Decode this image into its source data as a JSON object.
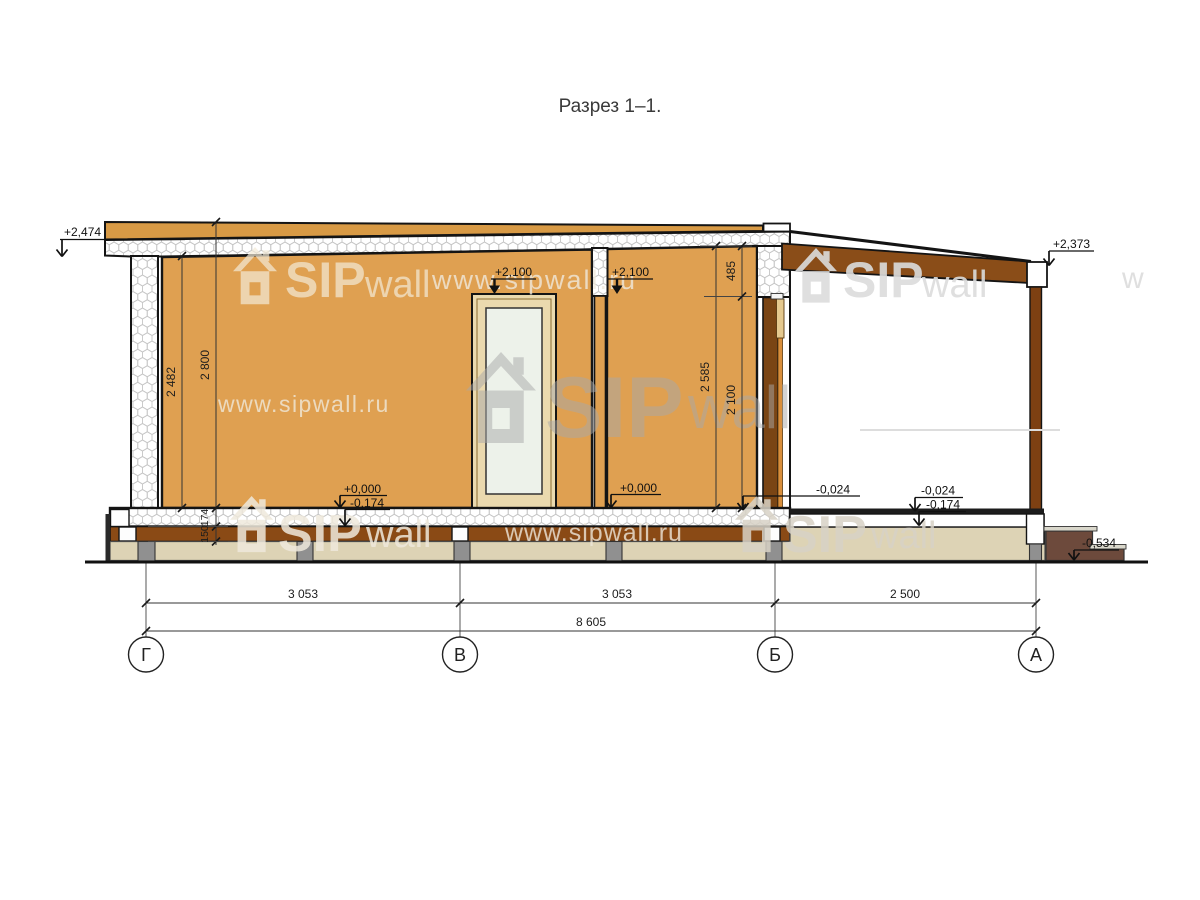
{
  "title": "Разрез 1–1.",
  "watermark": {
    "www": "www.sipwall.ru",
    "sip": "SIP",
    "wall": "wall",
    "w_fragment": "w"
  },
  "axes": {
    "G": "Г",
    "V": "В",
    "B": "Б",
    "A": "А"
  },
  "elevations": {
    "roof_left": "+2,474",
    "porch_roof_right": "+2,373",
    "door_head_left": "+2,100",
    "door_head_right": "+2,100",
    "floor_zero_left": "+0,000",
    "floor_bottom_left": "-0,174",
    "floor_zero_right": "+0,000",
    "porch_floor_near": "-0,024",
    "porch_floor_far": "-0,024",
    "porch_bottom_far": "-0,174",
    "ground_at_steps": "-0,534"
  },
  "dims": {
    "height_total": "2 800",
    "height_int_left": "2 482",
    "height_int_right": "2 585",
    "lintel": "485",
    "door_height": "2 100",
    "floor_panel": "174",
    "floor_beam": "150",
    "span_g_v": "3 053",
    "span_v_b": "3 053",
    "span_b_a": "2 500",
    "span_total": "8 605"
  }
}
